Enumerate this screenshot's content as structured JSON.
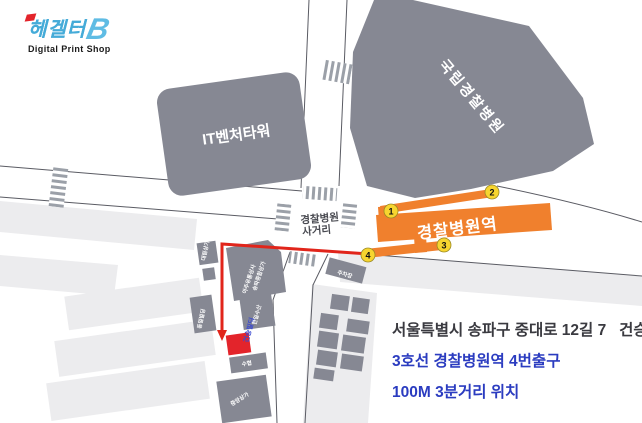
{
  "logo": {
    "brand": "헤겔터",
    "brand_mark": "B",
    "tagline": "Digital Print Shop",
    "brand_color": "#45ABD8",
    "accent_color": "#E3242B"
  },
  "info": {
    "address": "서울특별시 송파구 중대로 12길 7   건승빌딩",
    "subway": "3호선 경찰병원역 4번출구",
    "distance": "100M 3분거리 위치",
    "text_color": "#2B3CC0"
  },
  "map": {
    "hospital": {
      "name": "국립경찰병원"
    },
    "it_tower": {
      "name": "IT벤처타워"
    },
    "station": {
      "name": "경찰병원역",
      "color": "#F0802D",
      "exit_badge_color": "#F7D52F",
      "exits": [
        "1",
        "2",
        "3",
        "4"
      ]
    },
    "intersection": {
      "line1": "경찰병원",
      "line2": "사거리"
    },
    "destination": {
      "name": "건승빌딩",
      "building_color": "#E3242B",
      "label_color": "#3A49D0"
    },
    "route_color": "#E1251B",
    "building_color": "#868893",
    "block_color": "#ECECEE",
    "small_buildings": {
      "a": "대림상가",
      "c": "동일빌딩",
      "d1": "아주유통상사",
      "d2": "송파종합상가",
      "e": "한일수산",
      "f": "수협",
      "g": "중앙상가",
      "diag": "주차장"
    }
  }
}
